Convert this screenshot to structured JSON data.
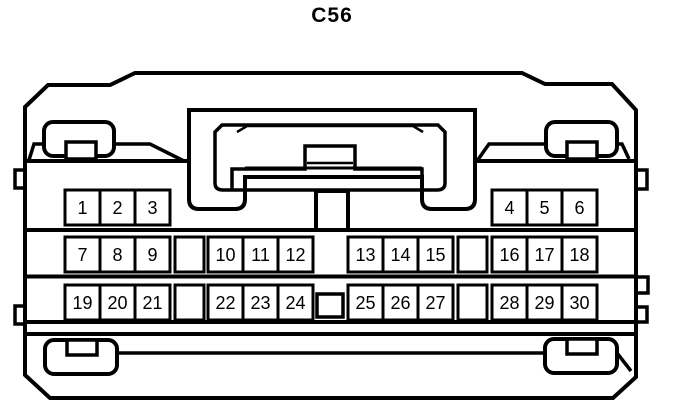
{
  "title": "C56",
  "diagram": {
    "type": "connector-pinout",
    "pin_labels": [
      "1",
      "2",
      "3",
      "4",
      "5",
      "6",
      "7",
      "8",
      "9",
      "10",
      "11",
      "12",
      "13",
      "14",
      "15",
      "16",
      "17",
      "18",
      "19",
      "20",
      "21",
      "22",
      "23",
      "24",
      "25",
      "26",
      "27",
      "28",
      "29",
      "30"
    ],
    "rows": [
      {
        "pins": [
          "1",
          "2",
          "3",
          "4",
          "5",
          "6"
        ]
      },
      {
        "pins": [
          "7",
          "8",
          "9",
          "10",
          "11",
          "12",
          "13",
          "14",
          "15",
          "16",
          "17",
          "18"
        ]
      },
      {
        "pins": [
          "19",
          "20",
          "21",
          "22",
          "23",
          "24",
          "25",
          "26",
          "27",
          "28",
          "29",
          "30"
        ]
      }
    ],
    "colors": {
      "line": "#000000",
      "background": "#ffffff"
    }
  }
}
